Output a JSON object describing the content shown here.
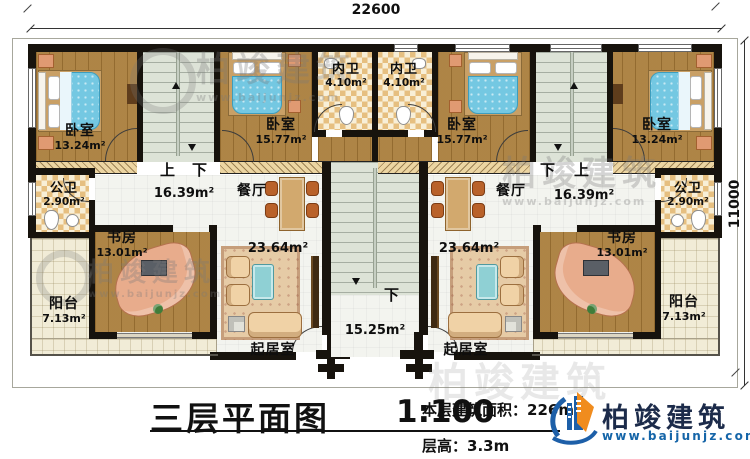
{
  "dims": {
    "top": "22600",
    "right": "11000"
  },
  "rooms": {
    "l_bed1": {
      "n": "卧室",
      "a": "13.24m²"
    },
    "l_bed2": {
      "n": "卧室",
      "a": "15.77m²"
    },
    "l_nw": {
      "n": "内卫",
      "a": "4.10m²"
    },
    "r_nw": {
      "n": "内卫",
      "a": "4.10m²"
    },
    "r_bed2": {
      "n": "卧室",
      "a": "15.77m²"
    },
    "r_bed1": {
      "n": "卧室",
      "a": "13.24m²"
    },
    "l_gw": {
      "n": "公卫",
      "a": "2.90m²"
    },
    "r_gw": {
      "n": "公卫",
      "a": "2.90m²"
    },
    "l_dining": {
      "n": "餐厅",
      "a": "16.39m²"
    },
    "r_dining": {
      "n": "餐厅",
      "a": "16.39m²"
    },
    "l_study": {
      "n": "书房",
      "a": "13.01m²"
    },
    "r_study": {
      "n": "书房",
      "a": "13.01m²"
    },
    "l_balcony": {
      "n": "阳台",
      "a": "7.13m²"
    },
    "r_balcony": {
      "n": "阳台",
      "a": "7.13m²"
    },
    "l_living": {
      "n": "起居室",
      "a": "23.64m²"
    },
    "r_living": {
      "n": "起居室",
      "a": "23.64m²"
    },
    "hall": {
      "a": "15.25m²"
    }
  },
  "stairs": {
    "l_up": "上",
    "l_down": "下",
    "r_down": "下",
    "r_up": "上",
    "hall_down": "下"
  },
  "footer": {
    "title": "三层平面图",
    "scale": "1:100",
    "area_label": "本层建筑面积：",
    "area_value": "226",
    "area_unit": "m²",
    "floor_label": "层高：",
    "floor_value": "3.3m"
  },
  "brand": {
    "name": "柏竣建筑",
    "url": "www.baijunjz.com"
  }
}
